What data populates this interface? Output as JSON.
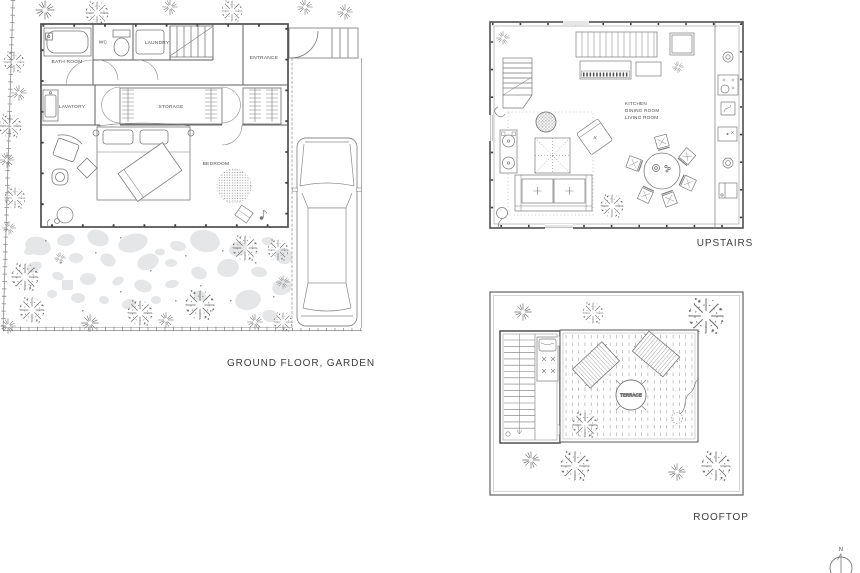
{
  "document": {
    "type": "architectural-floor-plan-sheet"
  },
  "plans": {
    "ground_floor": {
      "caption": "GROUND FLOOR, GARDEN",
      "rooms": {
        "bath_room": "BATH ROOM",
        "wc": "WC",
        "laundry": "LAUNDRY",
        "entrance": "ENTRANCE",
        "lavatory": "LAVATORY",
        "storage": "STORAGE",
        "bedroom": "BEDROOM"
      }
    },
    "upstairs": {
      "caption": "UPSTAIRS",
      "rooms": {
        "line1": "KITCHEN",
        "line2": "DINING ROOM",
        "line3": "LIVING ROOM"
      }
    },
    "rooftop": {
      "caption": "ROOFTOP",
      "rooms": {
        "terrace": "TERRACE"
      }
    }
  },
  "compass": {
    "north": "N"
  },
  "colors": {
    "wall": "#4f4f4f",
    "line": "#7a7a7a",
    "light_line": "#9a9a9a",
    "stone": "#e4e6e7",
    "text": "#3d3d3d",
    "background": "#ffffff"
  }
}
